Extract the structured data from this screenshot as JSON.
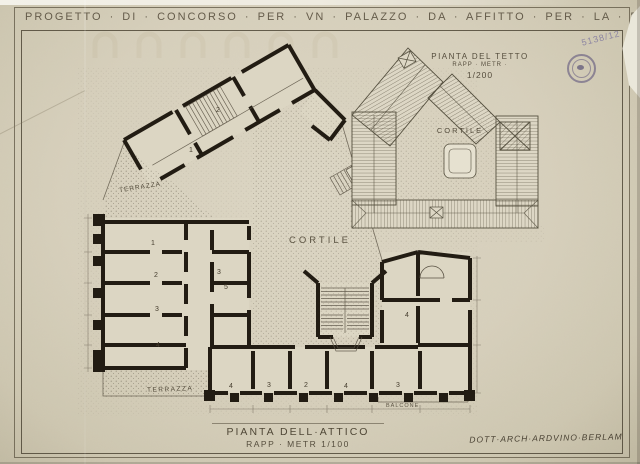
{
  "colors": {
    "paper": "#d8d1bd",
    "room_fill": "#dcd6c3",
    "wall_ink": "#221c13",
    "thin_line": "#5a5244",
    "lettering": "#5f5746",
    "stamp": "#584ea0",
    "pencil": "#7c749e"
  },
  "header": {
    "title": "PROGETTO · DI · CONCORSO · PER · VN · PALAZZO · DA · AFFITTO · PER · LA · R · A · S",
    "pencil_note": "5138/12"
  },
  "roof_plan": {
    "title": "PIANTA DEL TETTO",
    "scale_label": "RAPP · METR ·",
    "scale_value": "1/200",
    "courtyard": "CORTILE"
  },
  "attic_plan": {
    "courtyard": "CORTILE",
    "terrace_upper": "TERRAZZA",
    "terrace_lower": "TERRAZZA",
    "balcony": "BALCONE",
    "rooms": [
      {
        "n": "2"
      },
      {
        "n": "1"
      },
      {
        "n": "1"
      },
      {
        "n": "2"
      },
      {
        "n": "3"
      },
      {
        "n": "4"
      },
      {
        "n": "3"
      },
      {
        "n": "5"
      },
      {
        "n": "4"
      },
      {
        "n": "3"
      },
      {
        "n": "2"
      },
      {
        "n": "4"
      },
      {
        "n": "3"
      },
      {
        "n": "4"
      }
    ]
  },
  "titleblock": {
    "title": "PIANTA DELL·ATTICO",
    "scale": "RAPP · METR 1/100"
  },
  "signature": {
    "architect": "DOTT·ARCH·ARDVINO·BERLAM"
  }
}
